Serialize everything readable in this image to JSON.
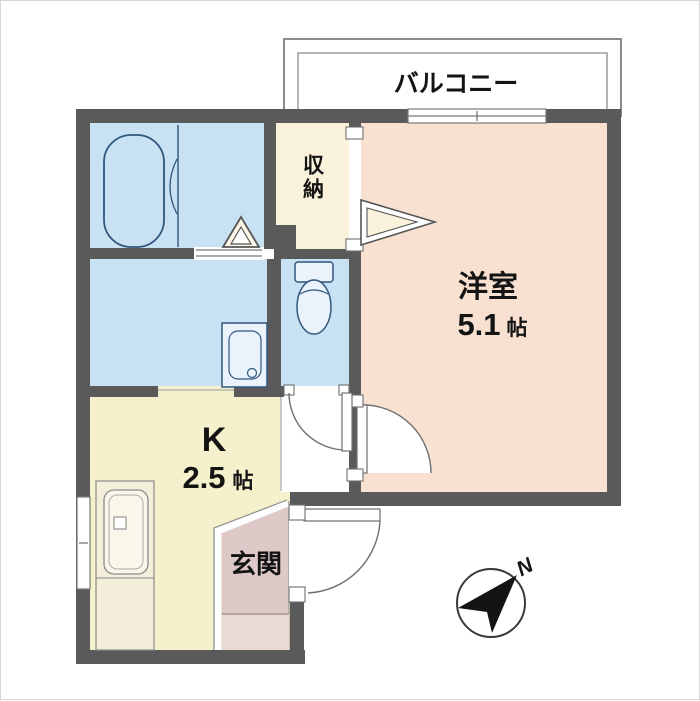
{
  "plan": {
    "balcony_label": "バルコニー",
    "western_room": {
      "name": "洋室",
      "size": "5.1",
      "unit": "帖"
    },
    "kitchen": {
      "name": "K",
      "size": "2.5",
      "unit": "帖"
    },
    "storage_label": "収納",
    "entrance_label": "玄関",
    "compass_north_label": "N"
  },
  "colors": {
    "wall": "#5a5a5a",
    "water_rooms": "#c8e1f3",
    "western_room": "#f8e1d1",
    "storage": "#faf2da",
    "kitchen": "#f5f1cc",
    "entrance": "#dec8c8",
    "entrance_step": "#eadad6",
    "counter": "#f3efdb",
    "fixture_stroke": "#30577d",
    "compass": "#141414"
  }
}
